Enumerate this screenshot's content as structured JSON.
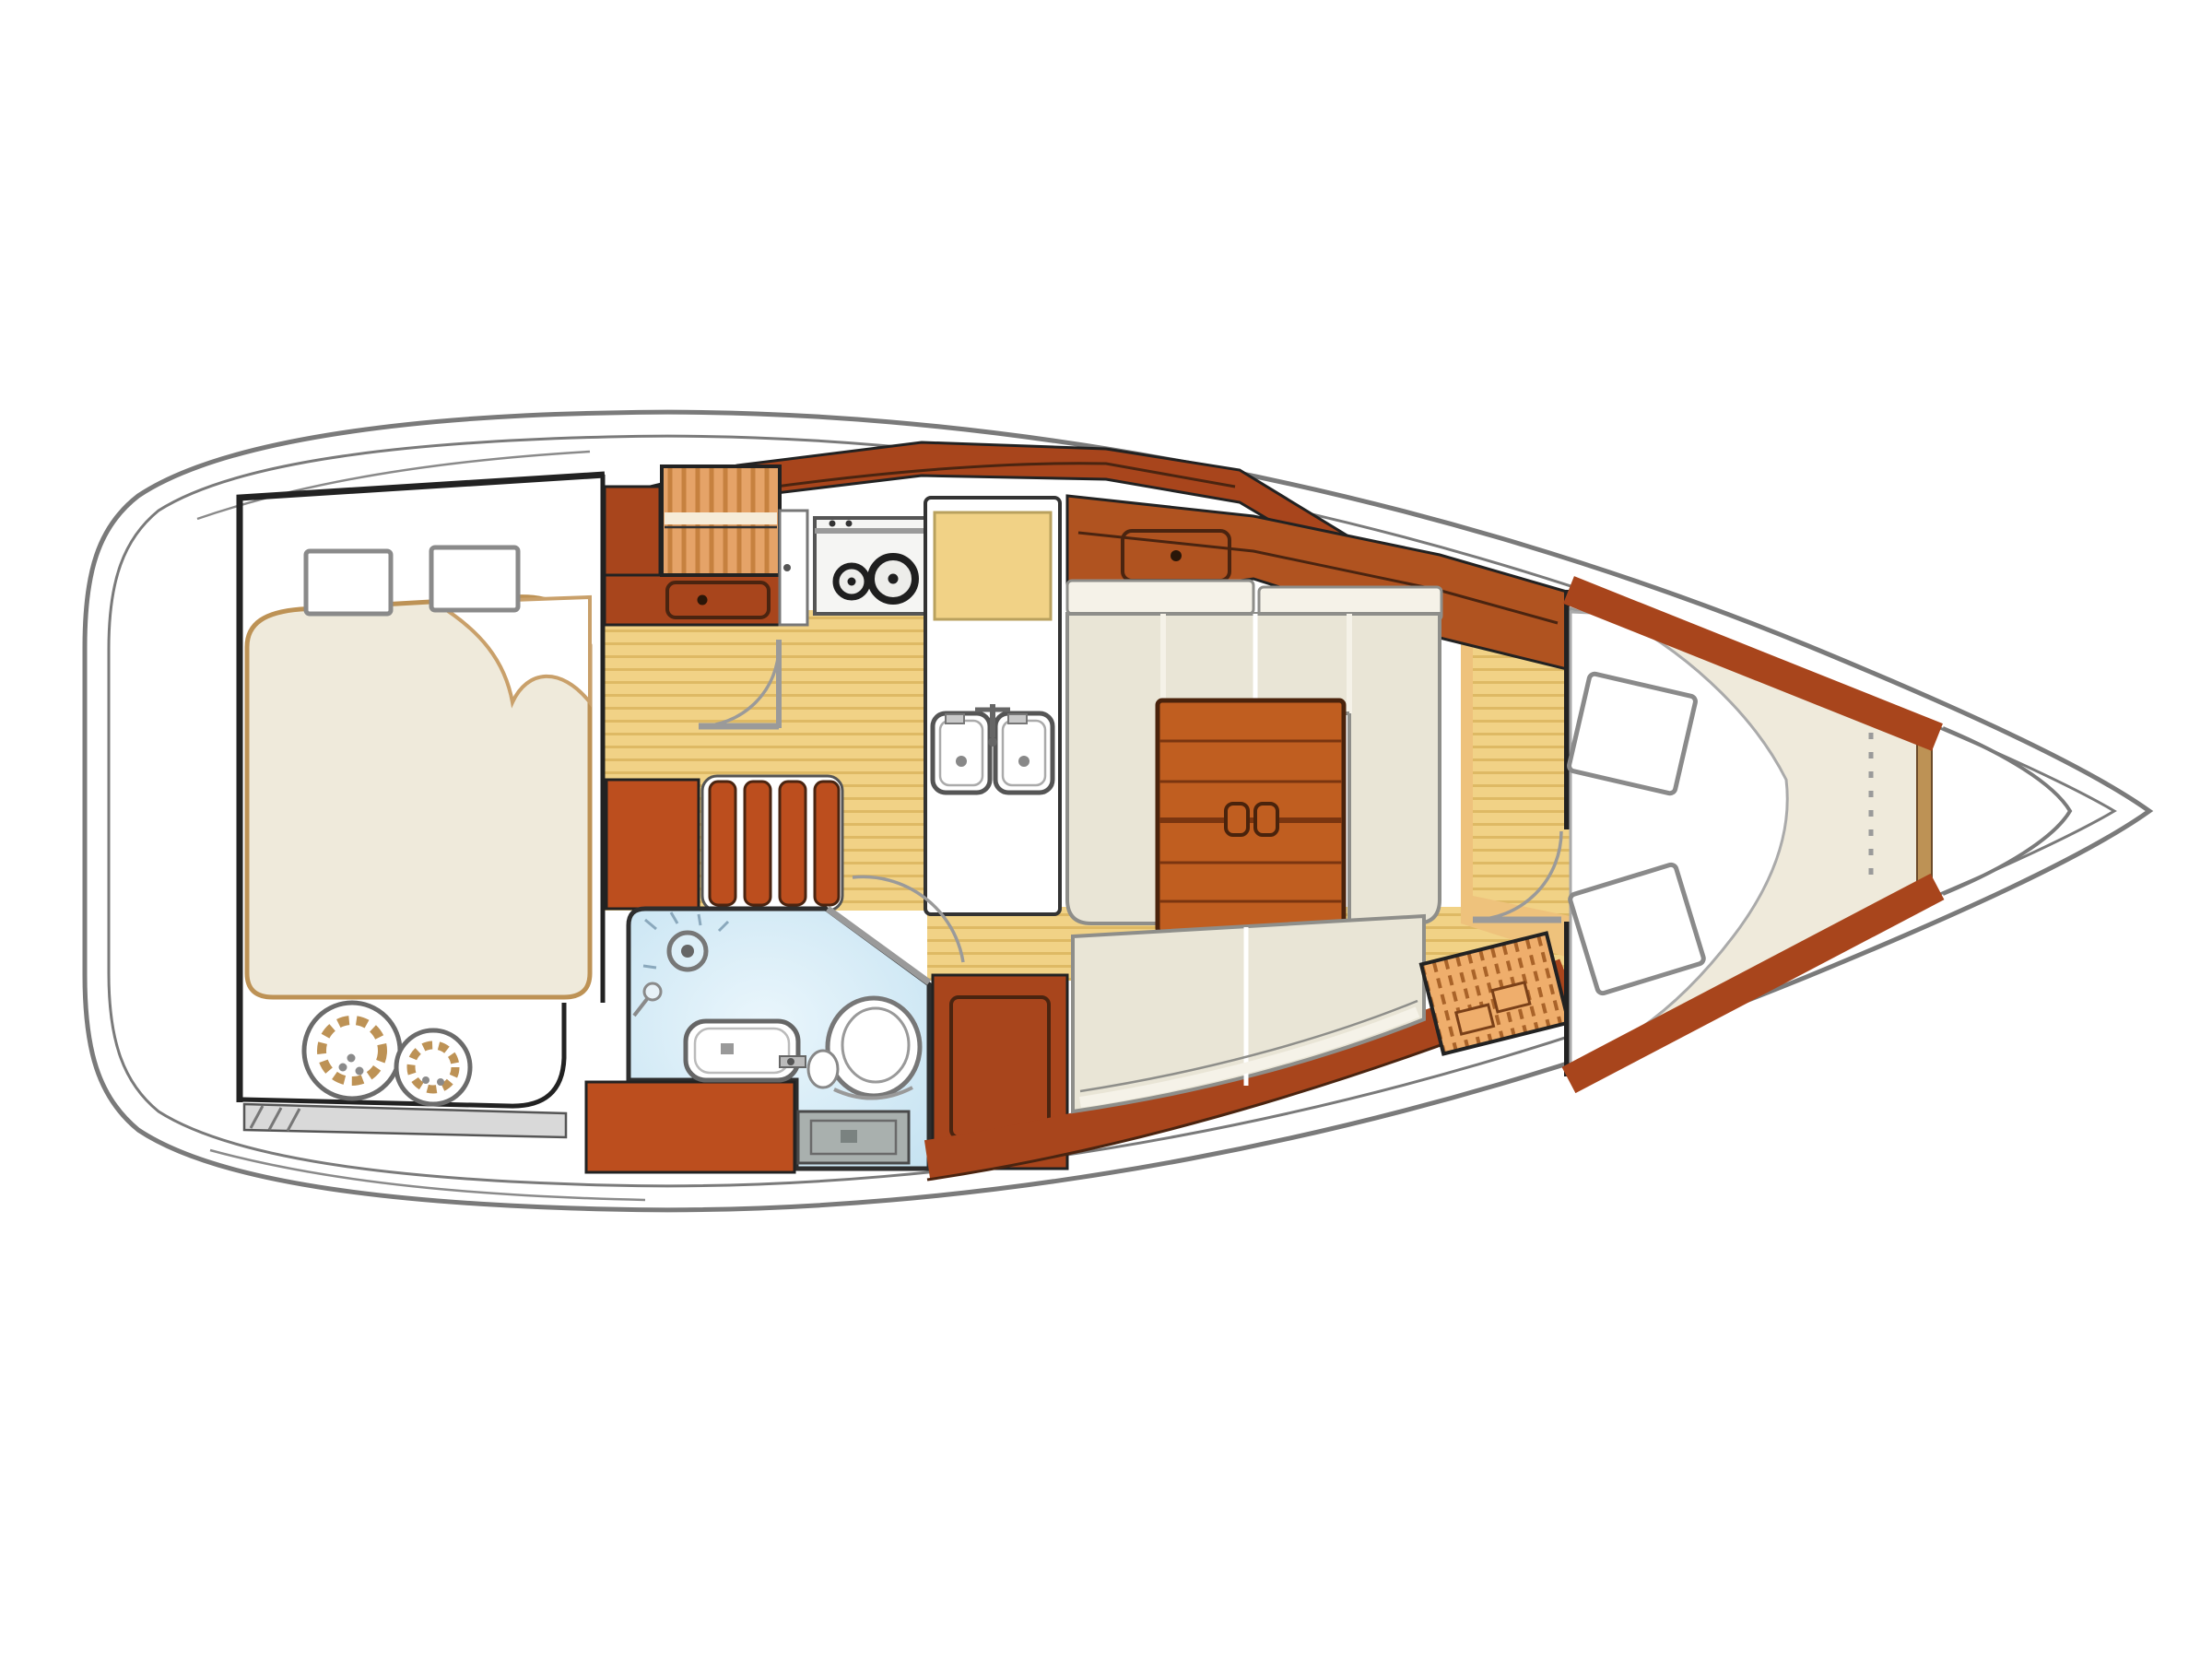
{
  "meta": {
    "type": "yacht-interior-floor-plan",
    "view": "top-down",
    "orientation": "bow-right"
  },
  "palette": {
    "paper": "#ffffff",
    "white": "#ffffff",
    "hull_outline": "#7a7a7a",
    "deck_line": "#8a8a8a",
    "line": "#222222",
    "dark_edge": "#4a2410",
    "steel": "#9a9a9a",
    "gray_detail": "#8a8a8a",
    "wood_dark": "#a8451c",
    "wood_red": "#bc4e1e",
    "wood_mid": "#b05320",
    "wood_table": "#c05e20",
    "wood_light": "#e5a368",
    "wood_light_hatch": "#c6813f",
    "louver": "#efae6c",
    "louver_hatch": "#a96329",
    "floor": "#f1d286",
    "floor_stripe": "#deb964",
    "floor_orange": "#eec27c",
    "mattress": "#efeadb",
    "mattress_edge": "#bd9255",
    "cushion": "#e9e5d6",
    "cushion_trim": "#f5f2e8",
    "cushion_edge": "#8e8e8a",
    "water_blue": "#c6e3f2",
    "water_blue_light": "#eaf6fc",
    "drawer_gray": "#a9b0ae",
    "drawer_gray_dark": "#7a8280",
    "stove_face": "#f5f5f3",
    "burner": "#1f1f1f",
    "base_strip_gray": "#d9d9d9"
  },
  "features": {
    "hull": "sailboat hull, bow to the right",
    "aft_cabin": "aft double cabin with berth, two pillows and rope coils locker",
    "companionway": "companionway steps with locker drawer",
    "galley": "galley with two-burner stove, worktop and double sink",
    "head": "head compartment with shower, washbasin and toilet",
    "saloon": "saloon with U-settee, folding table and straight settee",
    "forward_cabin": "forward V-berth cabin with two pillows",
    "doors": "door swing arcs at aft cabin, head and forward cabin"
  }
}
